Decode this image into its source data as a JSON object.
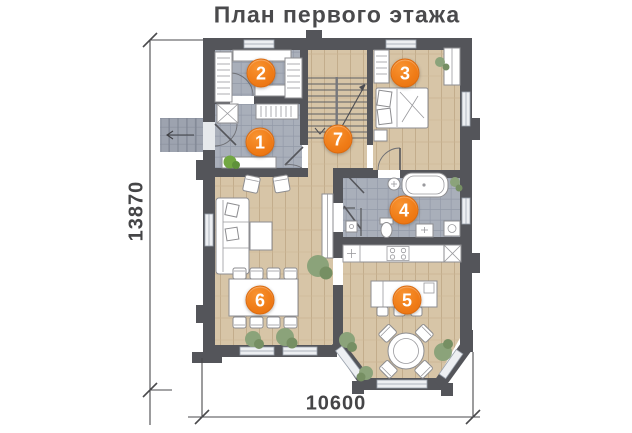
{
  "title": "План первого этажа",
  "dimensions": {
    "vertical": "13870",
    "horizontal": "10600"
  },
  "room_markers": [
    {
      "label": "1"
    },
    {
      "label": "2"
    },
    {
      "label": "3"
    },
    {
      "label": "4"
    },
    {
      "label": "5"
    },
    {
      "label": "6"
    },
    {
      "label": "7"
    }
  ],
  "colors": {
    "marker_orange": "#f07d18",
    "wall_gray": "#54555a",
    "wood_floor": "#d7c5a7",
    "tile_floor": "#a9afba",
    "text_gray": "#454547"
  }
}
